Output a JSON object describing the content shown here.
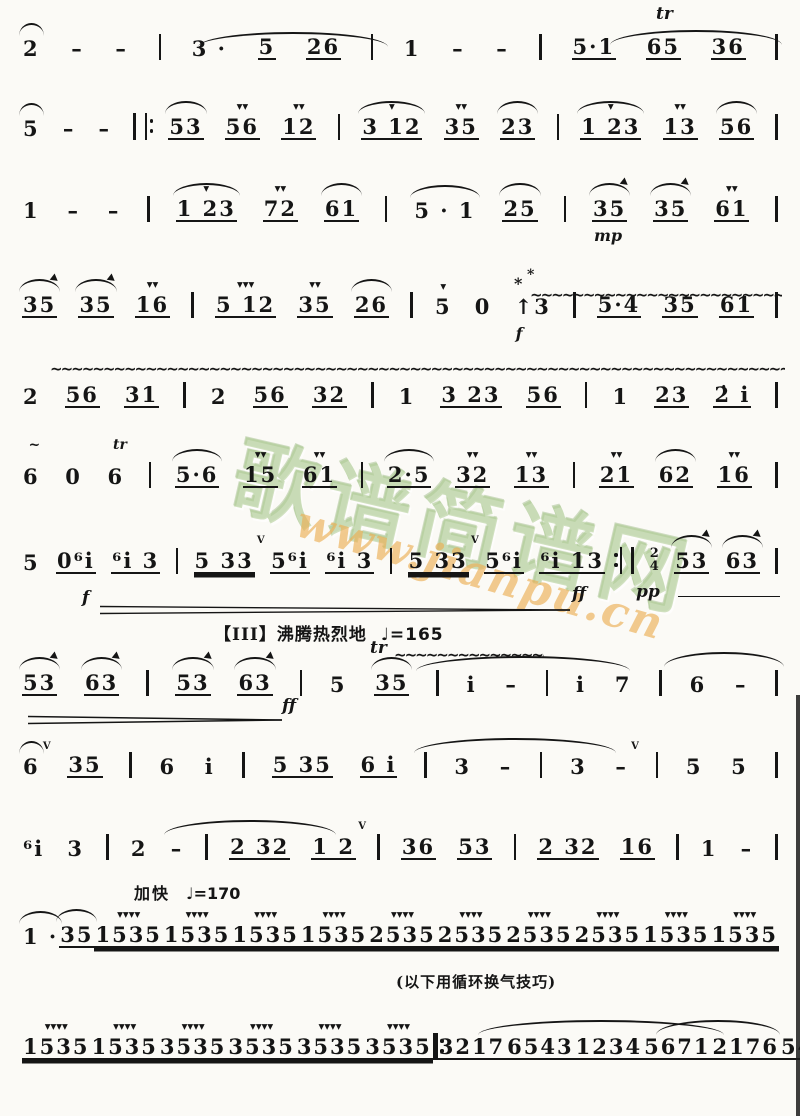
{
  "page": {
    "bg": "#fbfaf6",
    "ink": "#151515"
  },
  "watermark": {
    "cjk": "歌谱简谱网",
    "url": "www.jianpu.cn",
    "green": "#aac88c",
    "orange": "#ebaf55"
  },
  "section_header": {
    "label": "【III】沸腾热烈地",
    "tempo": "♩=165"
  },
  "tempo_accel": {
    "label": "加快",
    "tempo": "♩=170"
  },
  "breath_annotation": "(以下用循环换气技巧)",
  "score": {
    "systems": [
      {
        "top": 26,
        "tokens": [
          {
            "g": "2",
            "s": "arc"
          },
          {
            "g": "–"
          },
          {
            "g": "–"
          },
          {
            "b": "|"
          },
          {
            "g": "3 ·"
          },
          {
            "g": "5",
            "u": 1
          },
          {
            "g": "26",
            "u": 1
          },
          {
            "b": "|"
          },
          {
            "g": "1"
          },
          {
            "g": "–"
          },
          {
            "g": "–"
          },
          {
            "b": "|"
          },
          {
            "g": "5·1",
            "u": 1
          },
          {
            "g": "65",
            "u": 1
          },
          {
            "g": "36",
            "u": 1
          },
          {
            "b": "|"
          }
        ]
      },
      {
        "top": 106,
        "tokens": [
          {
            "g": "5",
            "s": "arc"
          },
          {
            "g": "–"
          },
          {
            "g": "–"
          },
          {
            "rb": 1
          },
          {
            "g": "53",
            "u": 1,
            "s": "arc"
          },
          {
            "g": "56",
            "u": 1,
            "a": 2
          },
          {
            "g": "12",
            "u": 1,
            "a": 2
          },
          {
            "b": "|"
          },
          {
            "g": "3 12",
            "u": 1,
            "a": 1,
            "s": "arc"
          },
          {
            "g": "35",
            "u": 1,
            "a": 2
          },
          {
            "g": "23",
            "u": 1,
            "s": "arc"
          },
          {
            "b": "|"
          },
          {
            "g": "1 23",
            "u": 1,
            "a": 1,
            "s": "arc"
          },
          {
            "g": "13",
            "u": 1,
            "a": 2
          },
          {
            "g": "56",
            "u": 1,
            "s": "arc"
          },
          {
            "b": "|"
          }
        ]
      },
      {
        "top": 188,
        "tokens": [
          {
            "g": "1"
          },
          {
            "g": "–"
          },
          {
            "g": "–"
          },
          {
            "b": "|"
          },
          {
            "g": "1 23",
            "u": 1,
            "a": 1,
            "s": "arc"
          },
          {
            "g": "72",
            "u": 1,
            "a": 2
          },
          {
            "g": "61",
            "u": 1,
            "s": "arc"
          },
          {
            "b": "|"
          },
          {
            "g": "5 · 1",
            "s": "arc"
          },
          {
            "g": "25",
            "u": 1,
            "s": "arc"
          },
          {
            "b": "|"
          },
          {
            "g": "35",
            "u": 1,
            "s": "arrow",
            "dyn": "mp"
          },
          {
            "g": "35",
            "u": 1,
            "s": "arrow"
          },
          {
            "g": "61",
            "u": 1,
            "a": 2
          },
          {
            "b": "|"
          }
        ]
      },
      {
        "top": 284,
        "tokens": [
          {
            "g": "35",
            "u": 1,
            "s": "arrow"
          },
          {
            "g": "35",
            "u": 1,
            "s": "arrow"
          },
          {
            "g": "16",
            "u": 1,
            "a": 2
          },
          {
            "b": "|"
          },
          {
            "g": "5 12",
            "u": 1,
            "a": 3
          },
          {
            "g": "35",
            "u": 1,
            "a": 2
          },
          {
            "g": "26",
            "u": 1,
            "s": "arc"
          },
          {
            "b": "|"
          },
          {
            "g": "5",
            "a": 1
          },
          {
            "g": "0"
          },
          {
            "g": "↑3",
            "lbl": "*",
            "dyn": "f"
          },
          {
            "b": "|"
          },
          {
            "g": "5·4",
            "u": 1
          },
          {
            "g": "35",
            "u": 1
          },
          {
            "g": "61",
            "u": 1
          },
          {
            "b": "|"
          }
        ]
      },
      {
        "top": 374,
        "tokens": [
          {
            "g": "2"
          },
          {
            "g": "56",
            "u": 1
          },
          {
            "g": "31",
            "u": 1
          },
          {
            "b": "|"
          },
          {
            "g": "2"
          },
          {
            "g": "56",
            "u": 1
          },
          {
            "g": "32",
            "u": 1
          },
          {
            "b": "|"
          },
          {
            "g": "1"
          },
          {
            "g": "3 23",
            "u": 1
          },
          {
            "g": "56",
            "u": 1
          },
          {
            "b": "|"
          },
          {
            "g": "1"
          },
          {
            "g": "23",
            "u": 1
          },
          {
            "g": "2̇ i",
            "u": 1
          },
          {
            "b": "|"
          }
        ]
      },
      {
        "top": 454,
        "tokens": [
          {
            "g": "6",
            "lbl": "~"
          },
          {
            "g": "0"
          },
          {
            "g": "6",
            "lbl": "tr"
          },
          {
            "b": "|"
          },
          {
            "g": "5·6",
            "u": 1,
            "s": "arc"
          },
          {
            "g": "15",
            "u": 1,
            "a": 2
          },
          {
            "g": "61",
            "u": 1,
            "a": 2
          },
          {
            "b": "|"
          },
          {
            "g": "2·5",
            "u": 1,
            "s": "arc"
          },
          {
            "g": "32",
            "u": 1,
            "a": 2
          },
          {
            "g": "13",
            "u": 1,
            "a": 2
          },
          {
            "b": "|"
          },
          {
            "g": "21",
            "u": 1,
            "a": 2
          },
          {
            "g": "62",
            "u": 1,
            "s": "arc"
          },
          {
            "g": "16",
            "u": 1,
            "a": 2
          },
          {
            "b": "|"
          }
        ]
      },
      {
        "top": 540,
        "tokens": [
          {
            "g": "5"
          },
          {
            "g": "0⁶i",
            "u": 1
          },
          {
            "g": "⁶i 3",
            "u": 1
          },
          {
            "b": "|"
          },
          {
            "g": "5 33",
            "u": 2,
            "br": 1
          },
          {
            "g": "5⁶i",
            "u": 1
          },
          {
            "g": "⁶i 3",
            "u": 1
          },
          {
            "b": "|"
          },
          {
            "g": "5 33",
            "u": 2,
            "br": 1
          },
          {
            "g": "5⁶i",
            "u": 1
          },
          {
            "g": "⁶i 13",
            "u": 1
          },
          {
            "b": "‖"
          },
          {
            "ts": [
              "2",
              "4"
            ]
          },
          {
            "g": "53",
            "u": 1,
            "s": "arrow"
          },
          {
            "g": "63",
            "u": 1,
            "s": "arrow"
          },
          {
            "b": "|"
          }
        ]
      },
      {
        "top": 662,
        "tokens": [
          {
            "g": "53",
            "u": 1,
            "s": "arrow"
          },
          {
            "g": "63",
            "u": 1,
            "s": "arrow"
          },
          {
            "b": "|"
          },
          {
            "g": "53",
            "u": 1,
            "s": "arrow"
          },
          {
            "g": "63",
            "u": 1,
            "s": "arrow"
          },
          {
            "b": "|"
          },
          {
            "g": "5"
          },
          {
            "g": "35",
            "u": 1,
            "s": "arc"
          },
          {
            "b": "|"
          },
          {
            "g": "i"
          },
          {
            "g": "–"
          },
          {
            "b": "|"
          },
          {
            "g": "i"
          },
          {
            "g": "7"
          },
          {
            "b": "|"
          },
          {
            "g": "6"
          },
          {
            "g": "–"
          },
          {
            "b": "|"
          }
        ]
      },
      {
        "top": 744,
        "tokens": [
          {
            "g": "6",
            "s": "arc",
            "br": 1
          },
          {
            "g": "35",
            "u": 1
          },
          {
            "b": "|"
          },
          {
            "g": "6"
          },
          {
            "g": "i"
          },
          {
            "b": "|"
          },
          {
            "g": "5 35",
            "u": 1
          },
          {
            "g": "6 i",
            "u": 1
          },
          {
            "b": "|"
          },
          {
            "g": "3"
          },
          {
            "g": "–"
          },
          {
            "b": "|"
          },
          {
            "g": "3"
          },
          {
            "g": "–",
            "br": 1
          },
          {
            "b": "|"
          },
          {
            "g": "5"
          },
          {
            "g": "5"
          },
          {
            "b": "|"
          }
        ]
      },
      {
        "top": 826,
        "tokens": [
          {
            "g": "⁶i"
          },
          {
            "g": "3"
          },
          {
            "b": "|"
          },
          {
            "g": "2"
          },
          {
            "g": "–"
          },
          {
            "b": "|"
          },
          {
            "g": "2 32",
            "u": 1
          },
          {
            "g": "1 2",
            "u": 1,
            "br": 1
          },
          {
            "b": "|"
          },
          {
            "g": "36",
            "u": 1
          },
          {
            "g": "53",
            "u": 1
          },
          {
            "b": "|"
          },
          {
            "g": "2 32",
            "u": 1
          },
          {
            "g": "16",
            "u": 1
          },
          {
            "b": "|"
          },
          {
            "g": "1"
          },
          {
            "g": "–"
          },
          {
            "b": "|"
          }
        ]
      },
      {
        "top": 914,
        "tokens": [
          {
            "g": "1 ·",
            "s": "arc"
          },
          {
            "g": "35",
            "u": 1,
            "s": "arc"
          },
          {
            "b": "|"
          },
          {
            "g": "1535",
            "u": 2,
            "a": 4
          },
          {
            "g": "1535",
            "u": 2,
            "a": 4
          },
          {
            "b": "|"
          },
          {
            "g": "1535",
            "u": 2,
            "a": 4
          },
          {
            "g": "1535",
            "u": 2,
            "a": 4
          },
          {
            "b": "|"
          },
          {
            "g": "2535",
            "u": 2,
            "a": 4
          },
          {
            "g": "2535",
            "u": 2,
            "a": 4
          },
          {
            "b": "|"
          },
          {
            "g": "2535",
            "u": 2,
            "a": 4
          },
          {
            "g": "2535",
            "u": 2,
            "a": 4
          },
          {
            "b": "|"
          },
          {
            "g": "1535",
            "u": 2,
            "a": 4
          },
          {
            "g": "1535",
            "u": 2,
            "a": 4
          },
          {
            "b": "|"
          }
        ]
      },
      {
        "top": 1026,
        "tokens": [
          {
            "g": "1535",
            "u": 2,
            "a": 4
          },
          {
            "g": "1535",
            "u": 2,
            "a": 4
          },
          {
            "b": "|"
          },
          {
            "g": "3535",
            "u": 2,
            "a": 4
          },
          {
            "g": "3535",
            "u": 2,
            "a": 4
          },
          {
            "b": "|"
          },
          {
            "g": "3535",
            "u": 2,
            "a": 4
          },
          {
            "g": "3535",
            "u": 2,
            "a": 4
          },
          {
            "rb": 1
          },
          {
            "g": "3217",
            "u": 1
          },
          {
            "g": "6543",
            "u": 1
          },
          {
            "b": "|"
          },
          {
            "g": "1234",
            "u": 1
          },
          {
            "g": "5671",
            "u": 1
          },
          {
            "b": "|"
          },
          {
            "g": "2176",
            "u": 1
          },
          {
            "g": "5432",
            "u": 1
          },
          {
            "b": "|"
          }
        ]
      }
    ],
    "decorations": [
      {
        "type": "slur",
        "x": 198,
        "y": 32,
        "w": 190
      },
      {
        "type": "label",
        "x": 656,
        "y": 6,
        "text": "tr"
      },
      {
        "type": "slur",
        "x": 610,
        "y": 30,
        "w": 172
      },
      {
        "type": "label",
        "x": 514,
        "y": 276,
        "text": "*",
        "cls": "plain"
      },
      {
        "type": "wavy",
        "x": 530,
        "y": 290,
        "w": 252
      },
      {
        "type": "wavy",
        "x": 50,
        "y": 364,
        "w": 735
      },
      {
        "type": "hairpin",
        "x": 100,
        "y": 600,
        "w": 470
      },
      {
        "type": "label",
        "x": 82,
        "y": 590,
        "text": "f"
      },
      {
        "type": "label",
        "x": 572,
        "y": 586,
        "text": "ff"
      },
      {
        "type": "label",
        "x": 636,
        "y": 584,
        "text": "pp"
      },
      {
        "type": "dline",
        "x": 678,
        "y": 596,
        "w": 102
      },
      {
        "type": "label",
        "x": 370,
        "y": 640,
        "text": "tr"
      },
      {
        "type": "wavy",
        "x": 394,
        "y": 650,
        "w": 150
      },
      {
        "type": "slur",
        "x": 416,
        "y": 656,
        "w": 214
      },
      {
        "type": "slur",
        "x": 664,
        "y": 652,
        "w": 120
      },
      {
        "type": "hairpin",
        "x": 28,
        "y": 710,
        "w": 254
      },
      {
        "type": "label",
        "x": 282,
        "y": 698,
        "text": "ff"
      },
      {
        "type": "slur",
        "x": 414,
        "y": 738,
        "w": 202
      },
      {
        "type": "slur",
        "x": 164,
        "y": 820,
        "w": 172
      },
      {
        "type": "slur",
        "x": 478,
        "y": 1020,
        "w": 246
      },
      {
        "type": "slur",
        "x": 656,
        "y": 1020,
        "w": 124
      }
    ]
  }
}
